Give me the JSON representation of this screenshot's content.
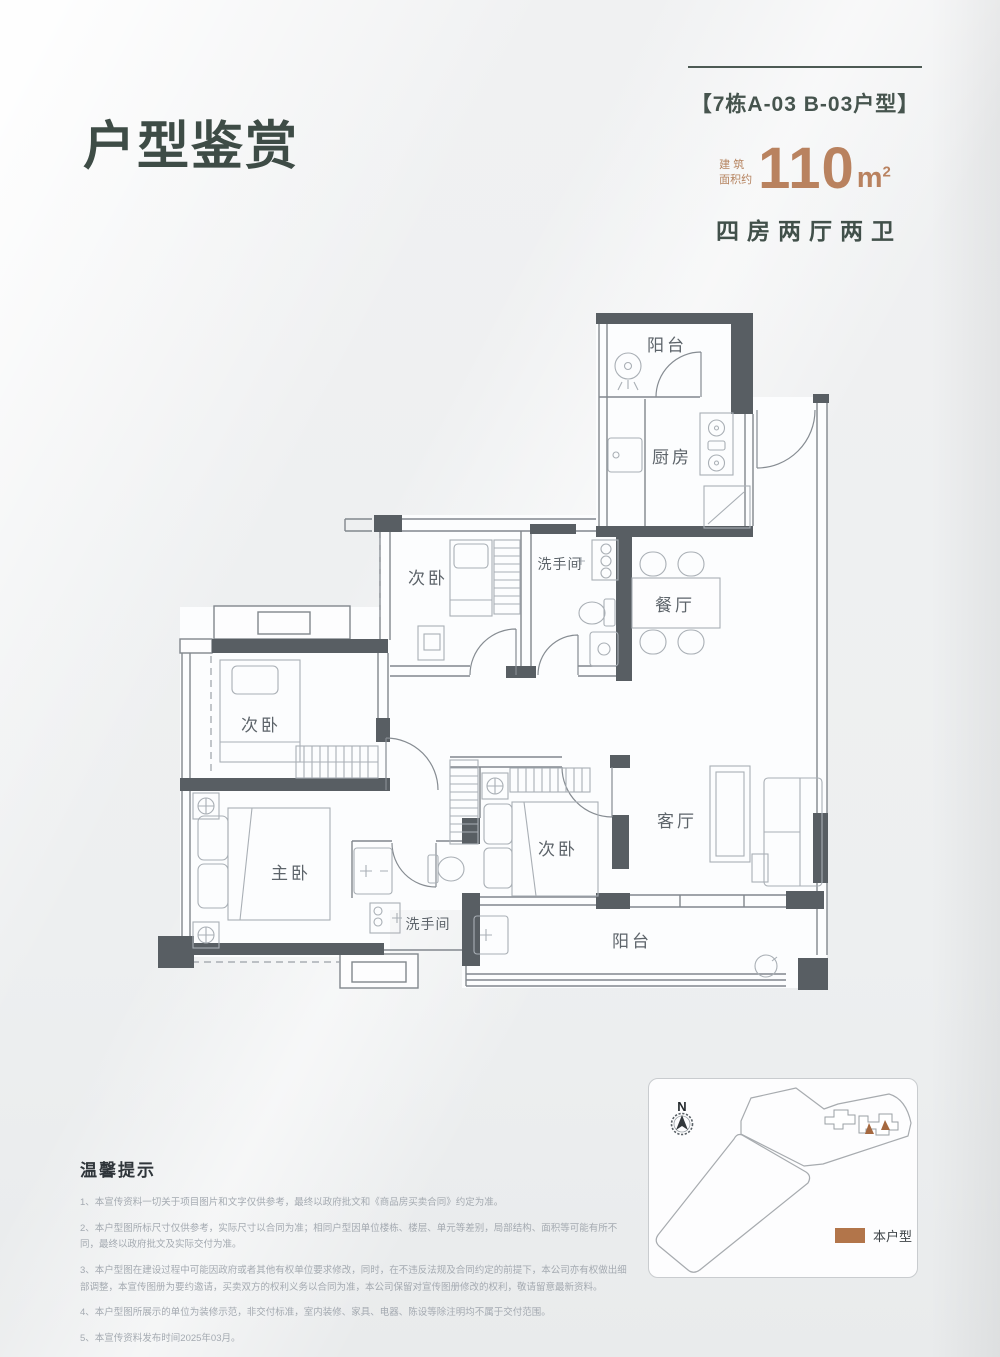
{
  "header": {
    "title": "户型鉴赏",
    "unit_tag": "【7栋A-03 B-03户型】",
    "area_label_line1": "建 筑",
    "area_label_line2": "面积约",
    "area_value": "110",
    "area_unit": "m",
    "area_exponent": "2",
    "layout_summary": "四房两厅两卫"
  },
  "floorplan": {
    "labels": {
      "balcony_top": "阳台",
      "kitchen": "厨房",
      "bedroom_top": "次卧",
      "bath_top": "洗手间",
      "dining": "餐厅",
      "bedroom_left": "次卧",
      "master_bedroom": "主卧",
      "bath_bottom": "洗手间",
      "bedroom_mid": "次卧",
      "living": "客厅",
      "balcony_bottom": "阳台"
    }
  },
  "tips": {
    "heading": "温馨提示",
    "items": [
      "1、本宣传资料一切关于项目图片和文字仅供参考，最终以政府批文和《商品房买卖合同》约定为准。",
      "2、本户型图所标尺寸仅供参考，实际尺寸以合同为准；相同户型因单位楼栋、楼层、单元等差别，局部结构、面积等可能有所不同，最终以政府批文及实际交付为准。",
      "3、本户型图在建设过程中可能因政府或者其他有权单位要求修改，同时，在不违反法规及合同约定的前提下，本公司亦有权做出细部调整，本宣传图册为要约邀请，买卖双方的权利义务以合同为准，本公司保留对宣传图册修改的权利，敬请留意最新资料。",
      "4、本户型图所展示的单位为装修示范，非交付标准，室内装修、家具、电器、陈设等除注明均不属于交付范围。",
      "5、本宣传资料发布时间2025年03月。"
    ]
  },
  "sitemap": {
    "compass_label": "N",
    "legend_label": "本户型",
    "legend_color": "#b2754a"
  }
}
